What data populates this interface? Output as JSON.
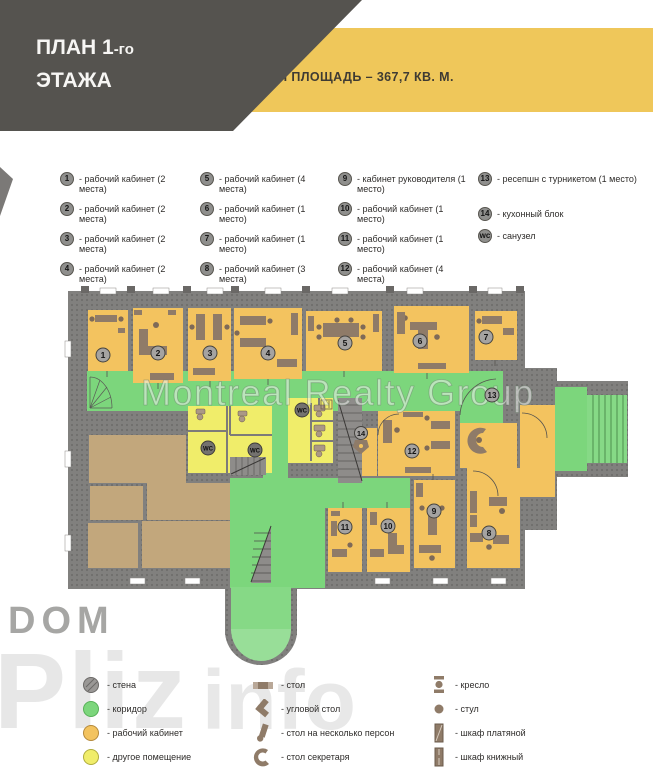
{
  "colors": {
    "header_gray": "#55534F",
    "accent_yellow": "#EFC75A",
    "wall_gray": "#81807E",
    "corridor_green": "#7CD67C",
    "office_orange": "#F3C35F",
    "other_room_yellow": "#F0ED6A",
    "room_tan": "#C2A77C",
    "furniture_brown": "#8F7B68"
  },
  "header": {
    "title_main": "ПЛАН 1",
    "title_suffix": "-го",
    "title_line2": "ЭТАЖА",
    "banner": "ОБЩАЯ ПЛОЩАДЬ – 367,7 КВ. М."
  },
  "room_legend": {
    "col1": [
      {
        "num": "1",
        "label": "- рабочий кабинет (2 места)"
      },
      {
        "num": "2",
        "label": "- рабочий кабинет (2 места)"
      },
      {
        "num": "3",
        "label": "- рабочий кабинет (2 места)"
      },
      {
        "num": "4",
        "label": "- рабочий кабинет (2 места)"
      }
    ],
    "col2": [
      {
        "num": "5",
        "label": "- рабочий кабинет (4 места)"
      },
      {
        "num": "6",
        "label": "- рабочий кабинет (1 место)"
      },
      {
        "num": "7",
        "label": "- рабочий кабинет (1 место)"
      },
      {
        "num": "8",
        "label": "- рабочий кабинет (3 места)"
      }
    ],
    "col3": [
      {
        "num": "9",
        "label": "- кабинет руководителя (1 место)"
      },
      {
        "num": "10",
        "label": "- рабочий кабинет (1 место)"
      },
      {
        "num": "11",
        "label": "- рабочий кабинет (1 место)"
      },
      {
        "num": "12",
        "label": "- рабочий кабинет (4 места)"
      }
    ],
    "col4": [
      {
        "num": "13",
        "label": "- ресепшн с турникетом (1 место)"
      },
      {
        "num": "14",
        "label": "- кухонный блок"
      },
      {
        "num": "wc",
        "label": "- санузел"
      }
    ]
  },
  "plan": {
    "watermark": "Montreal Realty Group",
    "rooms": {
      "r1": "1",
      "r2": "2",
      "r3": "3",
      "r4": "4",
      "r5": "5",
      "r6": "6",
      "r7": "7",
      "r8": "8",
      "r9": "9",
      "r10": "10",
      "r11": "11",
      "r12": "12",
      "r13": "13",
      "r14": "14",
      "wc": "WC"
    }
  },
  "symbol_legend": {
    "col1": [
      {
        "label": "- стена"
      },
      {
        "label": "- коридор"
      },
      {
        "label": "- рабочий кабинет"
      },
      {
        "label": "- другое помещение"
      }
    ],
    "col2": [
      {
        "label": "- стол"
      },
      {
        "label": "- угловой стол"
      },
      {
        "label": "- стол на несколько персон"
      },
      {
        "label": "- стол секретаря"
      }
    ],
    "col3": [
      {
        "label": "- кресло"
      },
      {
        "label": "- стул"
      },
      {
        "label": "- шкаф платяной"
      },
      {
        "label": "- шкаф книжный"
      }
    ]
  },
  "watermarks": {
    "dom": "DOM",
    "pliz": "Pliz",
    "info": "info"
  }
}
